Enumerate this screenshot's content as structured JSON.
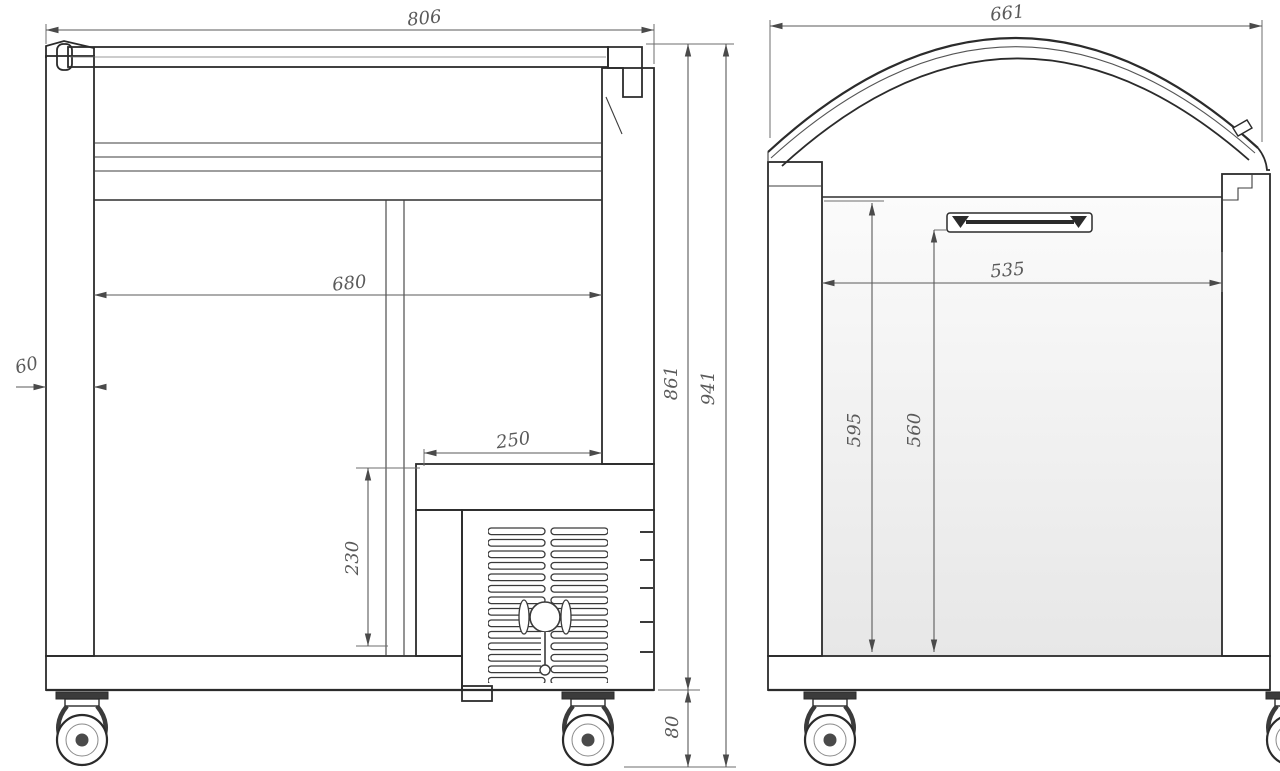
{
  "side_view": {
    "overall_width": "806",
    "inner_width": "680",
    "recess_width": "250",
    "recess_height": "230",
    "wall_thickness": "60",
    "height_without_casters": "861",
    "overall_height": "941",
    "caster_height": "80"
  },
  "front_view": {
    "overall_width": "661",
    "inner_width": "535",
    "inner_height": "595",
    "clear_height": "560"
  },
  "colors": {
    "line": "#2b2b2b",
    "dimension_line": "#5a5a5a",
    "label_text": "#5a5a5a",
    "background": "#ffffff"
  }
}
